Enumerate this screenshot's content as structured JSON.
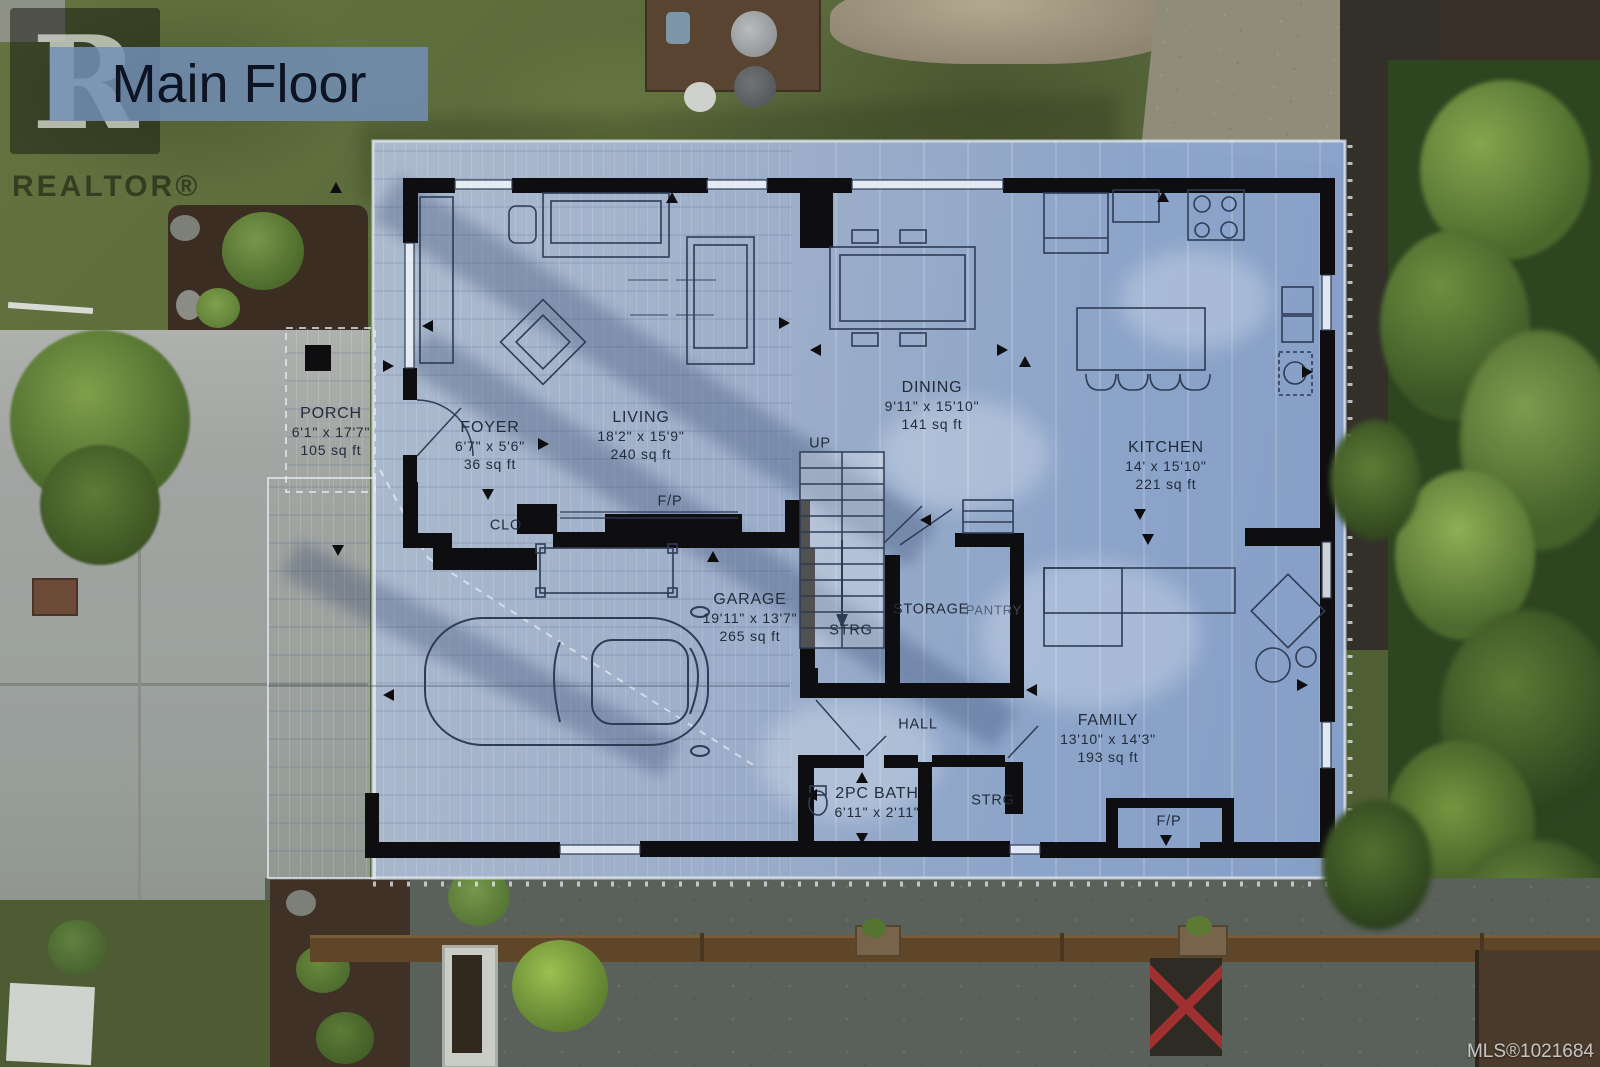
{
  "title_overlay": {
    "text": "Main Floor"
  },
  "branding": {
    "logo_letter": "R",
    "wordmark": "REALTOR®"
  },
  "watermark": {
    "mls": "MLS®1021684"
  },
  "rooms": {
    "porch": {
      "name": "PORCH",
      "dims": "6'1\" x 17'7\"",
      "area": "105 sq ft"
    },
    "foyer": {
      "name": "FOYER",
      "dims": "6'7\" x 5'6\"",
      "area": "36 sq ft"
    },
    "living": {
      "name": "LIVING",
      "dims": "18'2\" x 15'9\"",
      "area": "240 sq ft"
    },
    "dining": {
      "name": "DINING",
      "dims": "9'11\" x 15'10\"",
      "area": "141 sq ft"
    },
    "kitchen": {
      "name": "KITCHEN",
      "dims": "14' x 15'10\"",
      "area": "221 sq ft"
    },
    "garage": {
      "name": "GARAGE",
      "dims": "19'11\" x 13'7\"",
      "area": "265 sq ft"
    },
    "family": {
      "name": "FAMILY",
      "dims": "13'10\" x 14'3\"",
      "area": "193 sq ft"
    },
    "bath": {
      "name": "2PC BATH",
      "dims": "6'11\" x 2'11\""
    }
  },
  "annotations": {
    "clo": "CLO",
    "up": "UP",
    "fireplace1": "F/P",
    "fireplace2": "F/P",
    "storage": "STORAGE",
    "pantry": "PANTRY",
    "strg1": "STRG",
    "strg2": "STRG",
    "hall": "HALL"
  },
  "colors": {
    "plan_overlay": "#9fb4d6",
    "wall": "#0e0e10",
    "banner": "#7591b9",
    "plan_line": "#2e3c55",
    "grass": "#5a683c",
    "driveway": "#a2a5a2",
    "gravel": "#59615a",
    "foliage": "#4a6a2c",
    "deck_chair_red": "#a23a52"
  }
}
